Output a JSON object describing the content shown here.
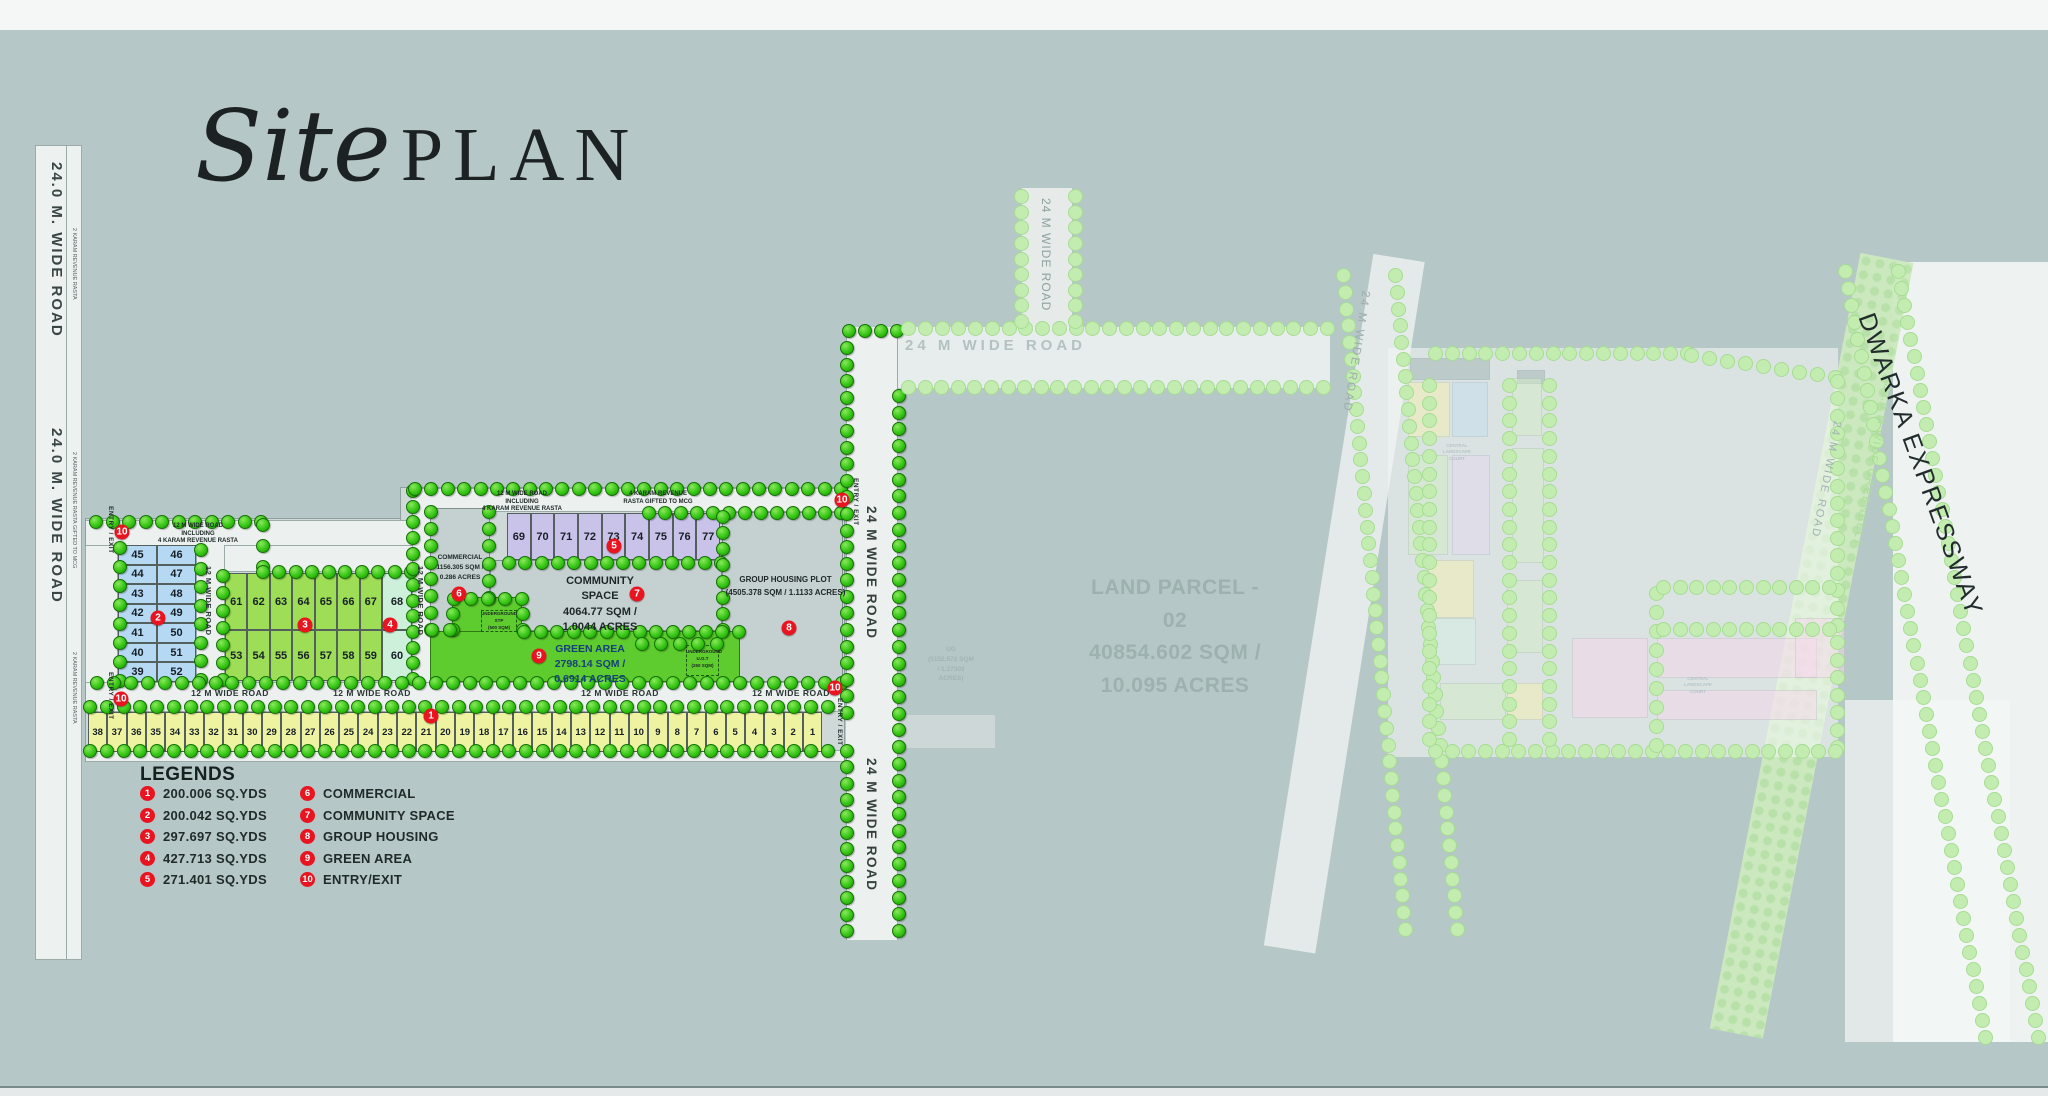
{
  "title": {
    "script": "Site",
    "plain": "PLAN"
  },
  "legend": {
    "heading": "LEGENDS",
    "left": [
      {
        "num": "1",
        "label": "200.006 SQ.YDS"
      },
      {
        "num": "2",
        "label": "200.042 SQ.YDS"
      },
      {
        "num": "3",
        "label": "297.697 SQ.YDS"
      },
      {
        "num": "4",
        "label": "427.713 SQ.YDS"
      },
      {
        "num": "5",
        "label": "271.401 SQ.YDS"
      }
    ],
    "right": [
      {
        "num": "6",
        "label": "COMMERCIAL"
      },
      {
        "num": "7",
        "label": "COMMUNITY SPACE"
      },
      {
        "num": "8",
        "label": "GROUP HOUSING"
      },
      {
        "num": "9",
        "label": "GREEN AREA"
      },
      {
        "num": "10",
        "label": "ENTRY/EXIT"
      }
    ]
  },
  "road_labels": {
    "left_road": "24.0 M. WIDE ROAD",
    "road_24m": "24 M WIDE ROAD",
    "road_24m_spaced": "24 M  WIDE ROAD",
    "road_12m": "12 M WIDE ROAD",
    "road_12m_including": [
      "12 M WIDE ROAD INCLUDING",
      "4 KARAM REVENUE RASTA"
    ],
    "rasta_4karam": [
      "4 KARAM REVENUE",
      "RASTA GIFTED TO MCG"
    ],
    "rasta_2karam": "2 KARAM REVENUE RASTA",
    "rasta_2karam_mcg": "2 KARAM REVENUE RASTA GIFTED TO MCG",
    "entry_exit": "ENTRY / EXIT",
    "greenbelt": "30.0 M WIDE GREENBELT",
    "expressway": "DWARKA EXPRESSWAY"
  },
  "areas": {
    "commercial": [
      "COMMERCIAL",
      "1156.305 SQM /",
      "0.286 ACRES"
    ],
    "community": [
      "COMMUNITY",
      "SPACE",
      "4064.77 SQM /",
      "1.0044 ACRES"
    ],
    "group_housing": [
      "GROUP HOUSING PLOT",
      "(4505.378 SQM / 1.1133 ACRES)"
    ],
    "green_area": [
      "GREEN AREA",
      "2798.14 SQM /",
      "0.6914 ACRES"
    ],
    "stp": [
      "UNDERGROUND",
      "STP",
      "(500 SQM)"
    ],
    "ugt": [
      "UNDERGROUND",
      "U.G.T",
      "(250 SQM)"
    ],
    "land_parcel": [
      "LAND PARCEL - 02",
      "40854.602 SQM /",
      "10.095 ACRES"
    ],
    "ug": [
      "UG",
      "(5152.572 SQM",
      "/ 1.27303 ACRES)"
    ],
    "landscape_court": [
      "CENTRAL LANDSCAPE",
      "COURT"
    ]
  },
  "plots": {
    "yellow": [
      38,
      37,
      36,
      35,
      34,
      33,
      32,
      31,
      30,
      29,
      28,
      27,
      26,
      25,
      24,
      23,
      22,
      21,
      20,
      19,
      18,
      17,
      16,
      15,
      14,
      13,
      12,
      11,
      10,
      9,
      8,
      7,
      6,
      5,
      4,
      3,
      2,
      1
    ],
    "blue_rows": [
      [
        45,
        46
      ],
      [
        44,
        47
      ],
      [
        43,
        48
      ],
      [
        42,
        49
      ],
      [
        41,
        50
      ],
      [
        40,
        51
      ],
      [
        39,
        52
      ]
    ],
    "green_top": [
      61,
      62,
      63,
      64,
      65,
      66,
      67
    ],
    "green_bottom": [
      53,
      54,
      55,
      56,
      57,
      58,
      59
    ],
    "cyan_top": "68",
    "cyan_bottom": "60",
    "purple": [
      69,
      70,
      71,
      72,
      73,
      74,
      75,
      76,
      77
    ]
  },
  "markers": [
    {
      "num": "1",
      "x": 431,
      "y": 716
    },
    {
      "num": "2",
      "x": 158,
      "y": 618
    },
    {
      "num": "3",
      "x": 305,
      "y": 625
    },
    {
      "num": "4",
      "x": 390,
      "y": 625
    },
    {
      "num": "5",
      "x": 614,
      "y": 546
    },
    {
      "num": "6",
      "x": 459,
      "y": 594
    },
    {
      "num": "7",
      "x": 637,
      "y": 594
    },
    {
      "num": "8",
      "x": 789,
      "y": 628
    },
    {
      "num": "9",
      "x": 539,
      "y": 656
    },
    {
      "num": "10",
      "x": 122,
      "y": 532
    },
    {
      "num": "10",
      "x": 121,
      "y": 699
    },
    {
      "num": "10",
      "x": 842,
      "y": 500
    },
    {
      "num": "10",
      "x": 835,
      "y": 688
    }
  ],
  "colors": {
    "background": "#b6c7c7",
    "plot_yellow": "#eef3a2",
    "plot_blue": "#b5d9f2",
    "plot_green": "#9ede56",
    "plot_cyan": "#ccf0da",
    "plot_purple": "#c9c3ea",
    "green_area": "#5ecb2e",
    "marker_red": "#e81520",
    "tree_green": "#35c614",
    "tree_pale": "#c3edb0"
  }
}
